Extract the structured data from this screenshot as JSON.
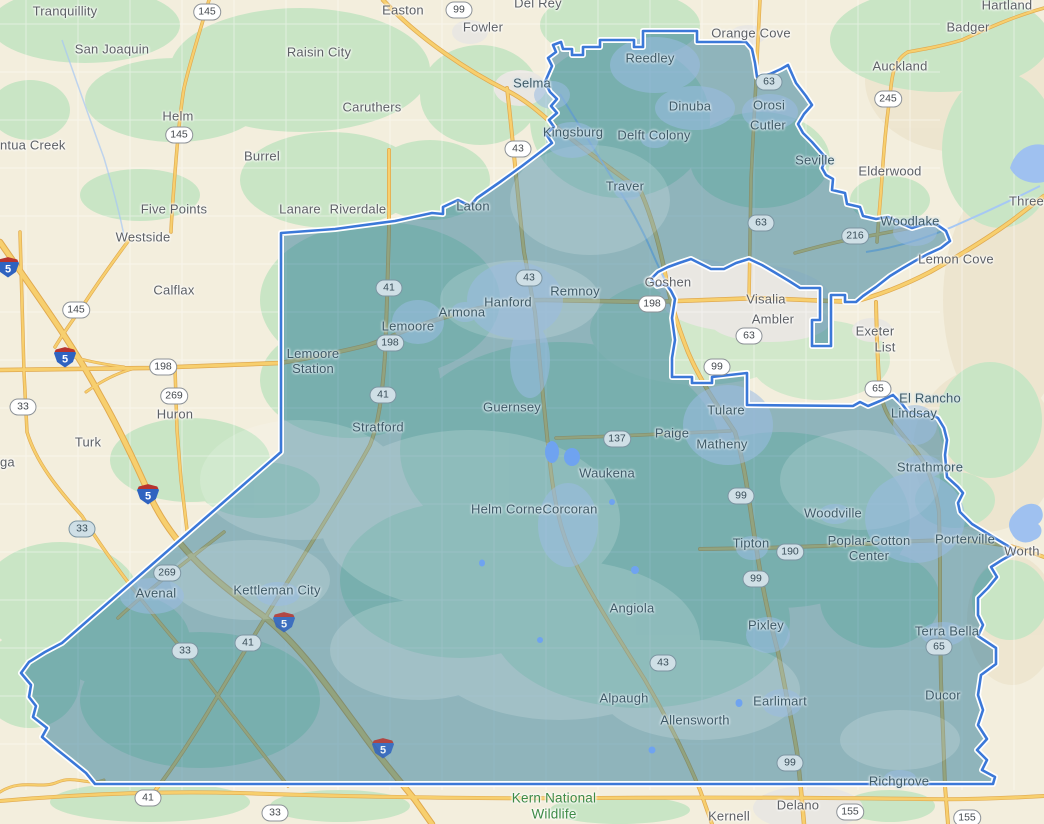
{
  "map": {
    "colors": {
      "land": "#f3eedd",
      "vegetation": "#c9e5c5",
      "hills": "#ece3cb",
      "urban_outside": "#e9e7e2",
      "urban_inside_tint": "#9abce3",
      "road_yellow": "#f7cf6e",
      "road_casing": "#e0a94f",
      "water": "#9fc1f0",
      "region_fill": "#166d93",
      "region_fill_opacity": 0.45,
      "boundary": "#3b78d8",
      "boundary_casing": "#ffffff"
    },
    "labels": [
      {
        "text": "Tranquillity",
        "x": 65,
        "y": 12,
        "style": "town"
      },
      {
        "text": "San Joaquin",
        "x": 112,
        "y": 50,
        "style": "town"
      },
      {
        "text": "Raisin City",
        "x": 319,
        "y": 53,
        "style": "town"
      },
      {
        "text": "Easton",
        "x": 403,
        "y": 11,
        "style": "town"
      },
      {
        "text": "Fowler",
        "x": 483,
        "y": 28,
        "style": "town"
      },
      {
        "text": "Del Rey",
        "x": 538,
        "y": 4,
        "style": "town"
      },
      {
        "text": "Caruthers",
        "x": 372,
        "y": 108,
        "style": "town"
      },
      {
        "text": "Helm",
        "x": 178,
        "y": 117,
        "style": "town"
      },
      {
        "text": "ntua Creek",
        "x": 0,
        "y": 146,
        "style": "town",
        "anchor": "left"
      },
      {
        "text": "Burrel",
        "x": 262,
        "y": 157,
        "style": "town"
      },
      {
        "text": "Five Points",
        "x": 174,
        "y": 210,
        "style": "town"
      },
      {
        "text": "Lanare",
        "x": 300,
        "y": 210,
        "style": "town"
      },
      {
        "text": "Riverdale",
        "x": 358,
        "y": 210,
        "style": "town"
      },
      {
        "text": "Westside",
        "x": 143,
        "y": 238,
        "style": "town"
      },
      {
        "text": "Calflax",
        "x": 174,
        "y": 291,
        "style": "town"
      },
      {
        "text": "Huron",
        "x": 175,
        "y": 415,
        "style": "town"
      },
      {
        "text": "Turk",
        "x": 88,
        "y": 443,
        "style": "town"
      },
      {
        "text": "ga",
        "x": 0,
        "y": 463,
        "style": "town",
        "anchor": "left"
      },
      {
        "text": "Orange Cove",
        "x": 751,
        "y": 34,
        "style": "town"
      },
      {
        "text": "Hartland",
        "x": 1007,
        "y": 6,
        "style": "town"
      },
      {
        "text": "Badger",
        "x": 968,
        "y": 28,
        "style": "town"
      },
      {
        "text": "Auckland",
        "x": 900,
        "y": 67,
        "style": "town"
      },
      {
        "text": "Elderwood",
        "x": 890,
        "y": 172,
        "style": "town"
      },
      {
        "text": "Lemon Cove",
        "x": 956,
        "y": 260,
        "style": "town"
      },
      {
        "text": "Three",
        "x": 1044,
        "y": 202,
        "style": "town",
        "anchor": "right"
      },
      {
        "text": "Goshen",
        "x": 668,
        "y": 283,
        "style": "town"
      },
      {
        "text": "Visalia",
        "x": 766,
        "y": 300,
        "style": "town"
      },
      {
        "text": "Ambler",
        "x": 773,
        "y": 320,
        "style": "town"
      },
      {
        "text": "Exeter",
        "x": 875,
        "y": 332,
        "style": "town"
      },
      {
        "text": "List",
        "x": 885,
        "y": 348,
        "style": "town"
      },
      {
        "text": "Worth",
        "x": 1022,
        "y": 552,
        "style": "town"
      },
      {
        "text": "Delano",
        "x": 798,
        "y": 806,
        "style": "town"
      },
      {
        "text": "Kernell",
        "x": 729,
        "y": 817,
        "style": "town"
      },
      {
        "lines": [
          "Kern National",
          "Wildlife"
        ],
        "x": 554,
        "y": 806,
        "style": "green"
      },
      {
        "text": "Reedley",
        "x": 650,
        "y": 59,
        "style": "town-in"
      },
      {
        "text": "Selma",
        "x": 532,
        "y": 84,
        "style": "town-in"
      },
      {
        "text": "Kingsburg",
        "x": 573,
        "y": 133,
        "style": "town-in"
      },
      {
        "text": "Dinuba",
        "x": 690,
        "y": 107,
        "style": "town-in"
      },
      {
        "text": "Orosi",
        "x": 769,
        "y": 106,
        "style": "town-in"
      },
      {
        "text": "Cutler",
        "x": 768,
        "y": 126,
        "style": "town-in"
      },
      {
        "text": "Delft Colony",
        "x": 654,
        "y": 136,
        "style": "town-in"
      },
      {
        "text": "Traver",
        "x": 625,
        "y": 187,
        "style": "town-in"
      },
      {
        "text": "Laton",
        "x": 473,
        "y": 207,
        "style": "town-in"
      },
      {
        "text": "Seville",
        "x": 815,
        "y": 161,
        "style": "town-in"
      },
      {
        "text": "Woodlake",
        "x": 910,
        "y": 222,
        "style": "town-in"
      },
      {
        "text": "Hanford",
        "x": 508,
        "y": 303,
        "style": "town-in"
      },
      {
        "text": "Armona",
        "x": 462,
        "y": 313,
        "style": "town-in"
      },
      {
        "text": "Remnoy",
        "x": 575,
        "y": 292,
        "style": "town-in"
      },
      {
        "text": "Lemoore",
        "x": 408,
        "y": 327,
        "style": "town-in"
      },
      {
        "lines": [
          "Lemoore",
          "Station"
        ],
        "x": 313,
        "y": 362,
        "style": "town-in"
      },
      {
        "text": "Stratford",
        "x": 378,
        "y": 428,
        "style": "town-in"
      },
      {
        "text": "Guernsey",
        "x": 512,
        "y": 408,
        "style": "town-in"
      },
      {
        "text": "Tulare",
        "x": 726,
        "y": 411,
        "style": "town-in"
      },
      {
        "text": "Paige",
        "x": 672,
        "y": 434,
        "style": "town-in"
      },
      {
        "text": "Matheny",
        "x": 722,
        "y": 445,
        "style": "town-in"
      },
      {
        "text": "El Rancho",
        "x": 930,
        "y": 399,
        "style": "town-in"
      },
      {
        "text": "Lindsay",
        "x": 914,
        "y": 414,
        "style": "town-in"
      },
      {
        "text": "Strathmore",
        "x": 930,
        "y": 468,
        "style": "town-in"
      },
      {
        "text": "Waukena",
        "x": 607,
        "y": 474,
        "style": "town-in"
      },
      {
        "text": "Helm Corner",
        "x": 509,
        "y": 510,
        "style": "town-in"
      },
      {
        "text": "Corcoran",
        "x": 570,
        "y": 510,
        "style": "town-in"
      },
      {
        "text": "Woodville",
        "x": 833,
        "y": 514,
        "style": "town-in"
      },
      {
        "text": "Tipton",
        "x": 751,
        "y": 544,
        "style": "town-in"
      },
      {
        "lines": [
          "Poplar-Cotton",
          "Center"
        ],
        "x": 869,
        "y": 549,
        "style": "town-in"
      },
      {
        "text": "Porterville",
        "x": 965,
        "y": 540,
        "style": "town-in"
      },
      {
        "text": "Pixley",
        "x": 766,
        "y": 626,
        "style": "town-in"
      },
      {
        "text": "Terra Bella",
        "x": 947,
        "y": 632,
        "style": "town-in"
      },
      {
        "text": "Ducor",
        "x": 943,
        "y": 696,
        "style": "town-in"
      },
      {
        "text": "Angiola",
        "x": 632,
        "y": 609,
        "style": "town-in"
      },
      {
        "text": "Alpaugh",
        "x": 624,
        "y": 699,
        "style": "town-in"
      },
      {
        "text": "Allensworth",
        "x": 695,
        "y": 721,
        "style": "town-in"
      },
      {
        "text": "Earlimart",
        "x": 780,
        "y": 702,
        "style": "town-in"
      },
      {
        "text": "Avenal",
        "x": 156,
        "y": 594,
        "style": "town-in"
      },
      {
        "text": "Kettleman City",
        "x": 277,
        "y": 591,
        "style": "town-in"
      },
      {
        "text": "Richgrove",
        "x": 899,
        "y": 782,
        "style": "town-in"
      }
    ],
    "shields": [
      {
        "num": "145",
        "x": 207,
        "y": 12,
        "kind": "state",
        "tinted": false
      },
      {
        "num": "99",
        "x": 459,
        "y": 10,
        "kind": "state",
        "tinted": false
      },
      {
        "num": "145",
        "x": 179,
        "y": 135,
        "kind": "state",
        "tinted": false
      },
      {
        "num": "43",
        "x": 518,
        "y": 149,
        "kind": "state",
        "tinted": false
      },
      {
        "num": "63",
        "x": 769,
        "y": 82,
        "kind": "state",
        "tinted": true
      },
      {
        "num": "245",
        "x": 888,
        "y": 99,
        "kind": "state",
        "tinted": false
      },
      {
        "num": "63",
        "x": 761,
        "y": 223,
        "kind": "state",
        "tinted": true
      },
      {
        "num": "216",
        "x": 855,
        "y": 236,
        "kind": "state",
        "tinted": true
      },
      {
        "num": "145",
        "x": 76,
        "y": 310,
        "kind": "state",
        "tinted": false
      },
      {
        "num": "198",
        "x": 163,
        "y": 367,
        "kind": "state",
        "tinted": false
      },
      {
        "num": "269",
        "x": 174,
        "y": 396,
        "kind": "state",
        "tinted": false
      },
      {
        "num": "33",
        "x": 23,
        "y": 407,
        "kind": "state",
        "tinted": false
      },
      {
        "num": "41",
        "x": 389,
        "y": 288,
        "kind": "state",
        "tinted": true
      },
      {
        "num": "198",
        "x": 390,
        "y": 343,
        "kind": "state",
        "tinted": true
      },
      {
        "num": "41",
        "x": 383,
        "y": 395,
        "kind": "state",
        "tinted": true
      },
      {
        "num": "43",
        "x": 529,
        "y": 278,
        "kind": "state",
        "tinted": true
      },
      {
        "num": "198",
        "x": 652,
        "y": 304,
        "kind": "state",
        "tinted": false
      },
      {
        "num": "63",
        "x": 749,
        "y": 336,
        "kind": "state",
        "tinted": false
      },
      {
        "num": "99",
        "x": 717,
        "y": 367,
        "kind": "state",
        "tinted": false
      },
      {
        "num": "65",
        "x": 878,
        "y": 389,
        "kind": "state",
        "tinted": false
      },
      {
        "num": "137",
        "x": 617,
        "y": 439,
        "kind": "state",
        "tinted": true
      },
      {
        "num": "99",
        "x": 741,
        "y": 496,
        "kind": "state",
        "tinted": true
      },
      {
        "num": "190",
        "x": 790,
        "y": 552,
        "kind": "state",
        "tinted": true
      },
      {
        "num": "99",
        "x": 756,
        "y": 579,
        "kind": "state",
        "tinted": true
      },
      {
        "num": "65",
        "x": 939,
        "y": 647,
        "kind": "state",
        "tinted": true
      },
      {
        "num": "269",
        "x": 167,
        "y": 573,
        "kind": "state",
        "tinted": true
      },
      {
        "num": "33",
        "x": 82,
        "y": 529,
        "kind": "state",
        "tinted": true
      },
      {
        "num": "33",
        "x": 185,
        "y": 651,
        "kind": "state",
        "tinted": true
      },
      {
        "num": "41",
        "x": 248,
        "y": 643,
        "kind": "state",
        "tinted": true
      },
      {
        "num": "43",
        "x": 663,
        "y": 663,
        "kind": "state",
        "tinted": true
      },
      {
        "num": "99",
        "x": 790,
        "y": 763,
        "kind": "state",
        "tinted": true
      },
      {
        "num": "41",
        "x": 148,
        "y": 798,
        "kind": "state",
        "tinted": false
      },
      {
        "num": "33",
        "x": 275,
        "y": 813,
        "kind": "state",
        "tinted": false
      },
      {
        "num": "155",
        "x": 850,
        "y": 812,
        "kind": "state",
        "tinted": false
      },
      {
        "num": "155",
        "x": 967,
        "y": 818,
        "kind": "state",
        "tinted": false
      },
      {
        "num": "5",
        "x": 8,
        "y": 267,
        "kind": "interstate",
        "tinted": false
      },
      {
        "num": "5",
        "x": 65,
        "y": 357,
        "kind": "interstate",
        "tinted": false
      },
      {
        "num": "5",
        "x": 148,
        "y": 494,
        "kind": "interstate",
        "tinted": false
      },
      {
        "num": "5",
        "x": 284,
        "y": 622,
        "kind": "interstate",
        "tinted": true
      },
      {
        "num": "5",
        "x": 383,
        "y": 748,
        "kind": "interstate",
        "tinted": true
      }
    ]
  }
}
